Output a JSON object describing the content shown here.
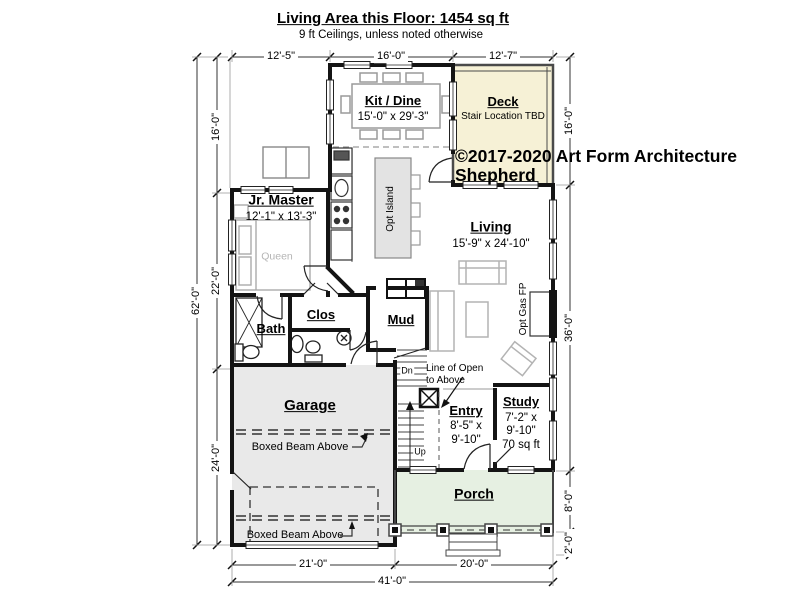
{
  "header": {
    "title": "Living Area this Floor: 1454 sq ft",
    "subtitle": "9 ft Ceilings, unless noted otherwise"
  },
  "copyright": {
    "line1": "©2017-2020 Art Form Architecture",
    "line2": "Shepherd"
  },
  "rooms": {
    "kit_dine": {
      "name": "Kit / Dine",
      "dims": "15'-0\" x 29'-3\""
    },
    "deck": {
      "name": "Deck",
      "note": "Stair Location TBD"
    },
    "jr_master": {
      "name": "Jr. Master",
      "dims": "12'-1\" x 13'-3\""
    },
    "living": {
      "name": "Living",
      "dims": "15'-9\" x 24'-10\""
    },
    "bath": {
      "name": "Bath"
    },
    "clos": {
      "name": "Clos"
    },
    "mud": {
      "name": "Mud"
    },
    "garage": {
      "name": "Garage"
    },
    "entry": {
      "name": "Entry",
      "dims_l1": "8'-5\" x",
      "dims_l2": "9'-10\""
    },
    "study": {
      "name": "Study",
      "dims_l1": "7'-2\" x",
      "dims_l2": "9'-10\"",
      "area": "70 sq ft"
    },
    "porch": {
      "name": "Porch"
    }
  },
  "annotations": {
    "queen": "Queen",
    "opt_island": "Opt Island",
    "opt_gas_fp": "Opt Gas FP",
    "boxed_beam": "Boxed Beam Above",
    "line_of_open_l1": "Line of Open",
    "line_of_open_l2": "to Above",
    "dn": "Dn",
    "up": "Up"
  },
  "dimensions": {
    "top": [
      "12'-5\"",
      "16'-0\"",
      "12'-7\""
    ],
    "left": [
      "16'-0\"",
      "22'-0\"",
      "24'-0\""
    ],
    "left_overall": "62'-0\"",
    "right": [
      "16'-0\"",
      "36'-0\"",
      "8'-0\"",
      "2'-0\""
    ],
    "bottom": [
      "21'-0\"",
      "20'-0\""
    ],
    "bottom_overall": "41'-0\""
  },
  "colors": {
    "deck_fill": "#f6f1d6",
    "garage_fill": "#e9e9e9",
    "porch_fill": "#e6f0e2",
    "island_fill": "#e3e3e3",
    "wall": "#141414"
  }
}
